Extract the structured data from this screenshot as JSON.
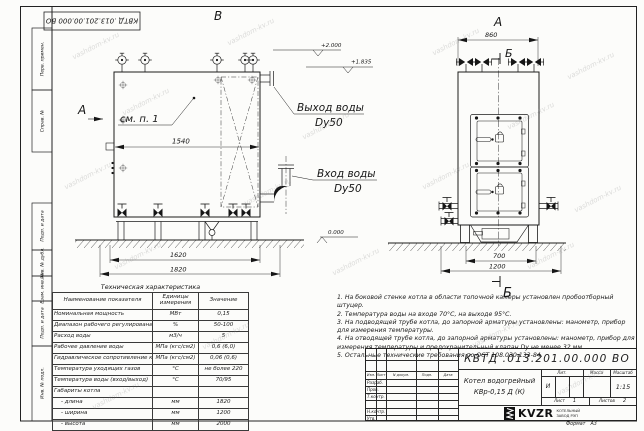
{
  "watermark": {
    "text": "vashdom-kv.ru"
  },
  "frame": {
    "doc_number_top": "КВТД .013.201.00.000  ВО",
    "stamps": [
      "Перв. примен.",
      "Справ. №",
      "Подп. и дата",
      "Инв. № дубл.",
      "Взам. инв. №",
      "Подп. и дата",
      "Инв. № подл."
    ]
  },
  "side_view": {
    "view_letter": "В",
    "arrow_label": "А",
    "detail_note": "см. п. 1",
    "dim_width": "1540",
    "dim_base": "1620",
    "dim_overall": "1820",
    "elev_top": "+2.000",
    "elev_mid": "+1.835",
    "elev_zero": "0.000",
    "outlet_label": "Выход воды",
    "outlet_dn": "Dy50",
    "inlet_label": "Вход воды",
    "inlet_dn": "Dy50"
  },
  "front_view": {
    "view_letter": "А",
    "dim_width": "860",
    "section_letter_top": "Б",
    "section_letter_bottom": "Б",
    "dim_inner": "700",
    "dim_outer": "1200"
  },
  "tech_table": {
    "title": "Техническая характеристика",
    "col_name": "Наименование показателя",
    "col_units": "Единицы измерения",
    "col_value": "Значение",
    "rows": [
      {
        "name": "Номинальная мощность",
        "units": "МВт",
        "value": "0,15"
      },
      {
        "name": "Диапазон рабочего регулирования",
        "units": "%",
        "value": "50-100"
      },
      {
        "name": "Расход воды",
        "units": "м3/ч",
        "value": "5"
      },
      {
        "name": "Рабочее давление воды",
        "units": "МПа (кгс/см2)",
        "value": "0,6 (6,0)"
      },
      {
        "name": "Гидравлическое сопротивление котла",
        "units": "МПа (кгс/см2)",
        "value": "0,06 (0,6)"
      },
      {
        "name": "Температура уходящих газов",
        "units": "°С",
        "value": "не более 220"
      },
      {
        "name": "Температура воды (вход/выход)",
        "units": "°С",
        "value": "70/95"
      },
      {
        "name": "Габариты котла",
        "units": "",
        "value": ""
      },
      {
        "name": "- длина",
        "units": "мм",
        "value": "1820"
      },
      {
        "name": "- ширина",
        "units": "мм",
        "value": "1200"
      },
      {
        "name": "- высота",
        "units": "мм",
        "value": "2000"
      }
    ]
  },
  "notes": [
    "1.  На боковой стенке котла в области топочной камеры установлен пробоотборный штуцер.",
    "2.  Температура воды на входе 70°С, на выходе 95°С.",
    "3.  На подводящей трубе котла, до запорной арматуры установлены: манометр, прибор для измерения температуры.",
    "4.  На отводящей трубе котла, до запорной арматуры установлены: манометр, прибор для измерения температуры и предохранительный клапан Dу не менее 32 мм.",
    "5.  Остальные технические требования по ОСТ 108.030.133-84."
  ],
  "title_block": {
    "doc_number": "КВТД .013.201.00.000  ВО",
    "cols": [
      "Изм.",
      "Лист",
      "N докум.",
      "Подп.",
      "Дата"
    ],
    "row_labels": [
      "Разраб.",
      "Пров.",
      "Т.контр.",
      "Н.контр.",
      "Утв."
    ],
    "product_name_1": "Котел водогрейный",
    "product_name_2": "КВр-0,15  Д  (К)",
    "lit_label": "Лит.",
    "lit_value": "И",
    "mass_label": "Масса",
    "scale_label": "Масштаб",
    "scale_value": "1:15",
    "sheet_label": "Лист",
    "sheet_value": "1",
    "sheets_label": "Листов",
    "sheets_value": "2",
    "logo": "KVZR",
    "logo_line1": "КОТЕЛЬНЫЙ",
    "logo_line2": "ЗАВОД РЭП",
    "format_label": "Формат",
    "format_value": "А3"
  }
}
